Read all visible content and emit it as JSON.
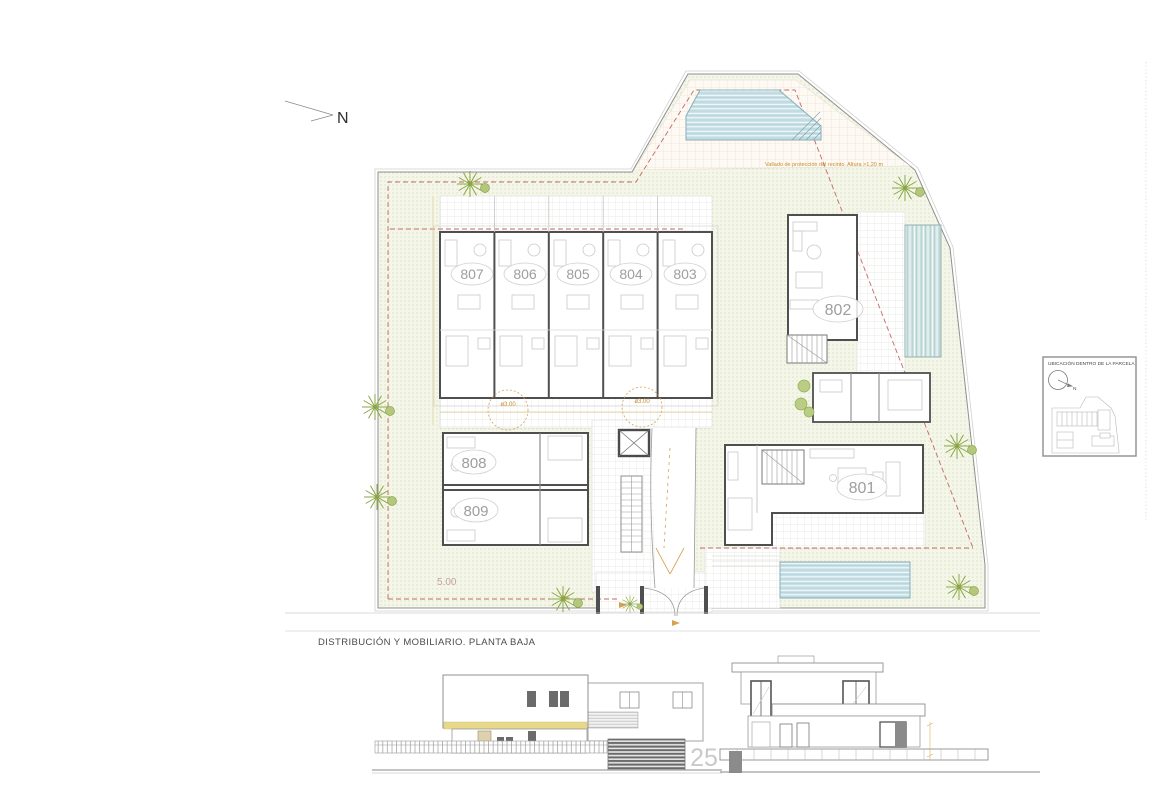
{
  "sheet": {
    "north_label": "N",
    "plan_title": "DISTRIBUCIÓN Y MOBILIARIO. PLANTA BAJA",
    "fence_note": "Vallado de protección del recinto. Altura >1,20 m",
    "setback_dim": "5.00",
    "tree_dim_1": "ø3.00",
    "tree_dim_2": "ø3.00",
    "units": {
      "u801": "801",
      "u802": "802",
      "u803": "803",
      "u804": "804",
      "u805": "805",
      "u806": "806",
      "u807": "807",
      "u808": "808",
      "u809": "809"
    },
    "legend": {
      "title": "UBICACIÓN DENTRO DE LA PARCELA",
      "north_label": "N"
    },
    "elevation": {
      "house_number": "25"
    },
    "colors": {
      "garden_dot": "#c2cb93",
      "pool_fill": "#c8e0e5",
      "setback_red": "#bc5a54",
      "annotation_orange": "#d8a152",
      "facade_band_yellow": "#e8d88a"
    }
  }
}
